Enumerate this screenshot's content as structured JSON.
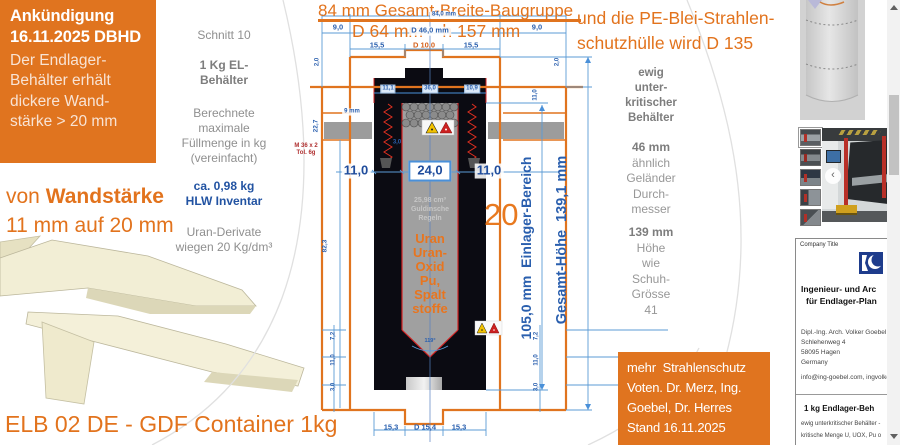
{
  "announcement": {
    "title_line1": "Ankündigung",
    "title_line2": "16.11.2025 DBHD",
    "body": "Der Endlager-\nBehälter erhält\ndickere Wand-\nstärke > 20 mm"
  },
  "wall_note": {
    "prefix": "von ",
    "bold": "Wandstärke",
    "line2": "11 mm auf 20 mm"
  },
  "footer_title": "ELB 02 DE - GDF Container 1kg",
  "specs": {
    "section": "Schnitt 10",
    "container": "1 Kg EL-\nBehälter",
    "filling": "Berechnete\nmaximale\nFüllmenge in kg\n(vereinfacht)",
    "inventory": "ca. 0,98 kg\nHLW Inventar",
    "uranium": "Uran-Derivate\nwiegen 20 Kg/dm³"
  },
  "drawing": {
    "heading_width": "84 mm Gesamt-Breite-Baugruppe",
    "heading_dims": "D 64 mm    h 157 mm",
    "vertical_inner": "105,0 mm  Einlager-Bereich",
    "vertical_outer": "Gesamt-Höhe  139,1 mm",
    "wall_callout": "20",
    "volume_note": "25,98 cm³\nGuldinsche\nRegeln",
    "content_label": "Uran\nUran-\nOxid\nPu,\nSpalt\nstoffe",
    "dim_labels": [
      {
        "t": "84,0 mm",
        "x": 444,
        "y": 15,
        "cls": "micro chip"
      },
      {
        "t": "D 46,0 mm",
        "x": 430,
        "y": 31,
        "cls": "tinyplus chip"
      },
      {
        "t": "9,0",
        "x": 338,
        "y": 28,
        "cls": "tinyplus"
      },
      {
        "t": "9,0",
        "x": 537,
        "y": 28,
        "cls": "tinyplus"
      },
      {
        "t": "15,5",
        "x": 377,
        "y": 46,
        "cls": "tinyplus"
      },
      {
        "t": "D 10,0",
        "x": 424,
        "y": 46,
        "cls": "tinyplus accent"
      },
      {
        "t": "15,5",
        "x": 471,
        "y": 46,
        "cls": "tinyplus"
      },
      {
        "t": "2,0",
        "x": 318,
        "y": 62,
        "rot": 1,
        "cls": "micro"
      },
      {
        "t": "2,0",
        "x": 558,
        "y": 62,
        "rot": 1,
        "cls": "micro"
      },
      {
        "t": "11,0",
        "x": 536,
        "y": 95,
        "rot": 1,
        "cls": "micro"
      },
      {
        "t": "11,1",
        "x": 388,
        "y": 89,
        "cls": "micro chipblue"
      },
      {
        "t": "36,0",
        "x": 430,
        "y": 89,
        "cls": "micro chipblue"
      },
      {
        "t": "10,9",
        "x": 472,
        "y": 89,
        "cls": "micro chipblue"
      },
      {
        "t": "9 mm",
        "x": 352,
        "y": 112,
        "cls": "micro chip"
      },
      {
        "t": "3,0",
        "x": 397,
        "y": 143,
        "cls": "micro"
      },
      {
        "t": "M 36 x 2\nTol. 6g",
        "x": 306,
        "y": 150,
        "cls": "micro red"
      },
      {
        "t": "22,7",
        "x": 316,
        "y": 126,
        "rot": 1,
        "cls": "tiny"
      },
      {
        "t": "82,3",
        "x": 325,
        "y": 246,
        "rot": 1,
        "cls": "tiny"
      },
      {
        "t": "11,0",
        "x": 356,
        "y": 171,
        "cls": "big chip"
      },
      {
        "t": "24,0",
        "x": 430,
        "y": 171,
        "cls": "big box"
      },
      {
        "t": "11,0",
        "x": 489,
        "y": 171,
        "cls": "big chip"
      },
      {
        "t": "7,2",
        "x": 334,
        "y": 336,
        "rot": 1,
        "cls": "micro"
      },
      {
        "t": "11,0",
        "x": 334,
        "y": 360,
        "rot": 1,
        "cls": "micro"
      },
      {
        "t": "3,0",
        "x": 334,
        "y": 387,
        "rot": 1,
        "cls": "micro"
      },
      {
        "t": "7,2",
        "x": 537,
        "y": 336,
        "rot": 1,
        "cls": "micro"
      },
      {
        "t": "11,0",
        "x": 537,
        "y": 360,
        "rot": 1,
        "cls": "micro"
      },
      {
        "t": "3,0",
        "x": 537,
        "y": 387,
        "rot": 1,
        "cls": "micro"
      },
      {
        "t": "15,3",
        "x": 391,
        "y": 428,
        "cls": "tinyplus"
      },
      {
        "t": "D 15,4",
        "x": 425,
        "y": 428,
        "cls": "tinyplus"
      },
      {
        "t": "15,3",
        "x": 459,
        "y": 428,
        "cls": "tinyplus"
      },
      {
        "t": "119°",
        "x": 430,
        "y": 341,
        "cls": "nano"
      }
    ]
  },
  "pe_note": {
    "line1": "und die PE-Blei-Strahlen-",
    "line2": "schutzhülle wird D 135"
  },
  "right_specs": {
    "critical": "ewig\nunter-\nkritischer\nBehälter",
    "diameter": "46 mm",
    "diameter_note": "ähnlich\nGeländer\nDurch-\nmesser",
    "height": "139 mm",
    "height_note": "Höhe\nwie\nSchuh-\nGrösse\n41"
  },
  "votes_box": {
    "line1": "mehr  Strahlenschutz",
    "line2": "Voten. Dr. Merz, Ing.",
    "line3": "Goebel, Dr. Herres",
    "line4": "Stand 16.11.2025"
  },
  "business_card": {
    "company_label": "Company Title",
    "headline1": "Ingenieur- und Arc",
    "headline2": "für Endlager-Plan",
    "person": "Dipl.-Ing. Arch. Volker Goebel",
    "street": "Schlehenweg 4",
    "city": "58095 Hagen",
    "country": "Germany",
    "email_line": "info@ing-goebel.com, ingvolke",
    "product_title": "1 kg Endlager-Beh",
    "product_line1": "ewig unterkritischer Behälter -",
    "product_line2": "kritische Menge U, UOX, Pu o"
  },
  "gallery": {
    "thumbs": [
      "machine-photo-1",
      "machine-photo-2",
      "machine-photo-3",
      "machine-photo-4",
      "machine-photo-5"
    ],
    "prev_label": "‹"
  },
  "colors": {
    "accent_orange": "#e0741f",
    "dim_blue": "#4a90d9",
    "label_blue": "#2a5fae",
    "text_gray": "#8f8f8f",
    "hlw_blue": "#2253a2",
    "warn_yellow": "#f2c200",
    "warn_red": "#cc2020"
  }
}
